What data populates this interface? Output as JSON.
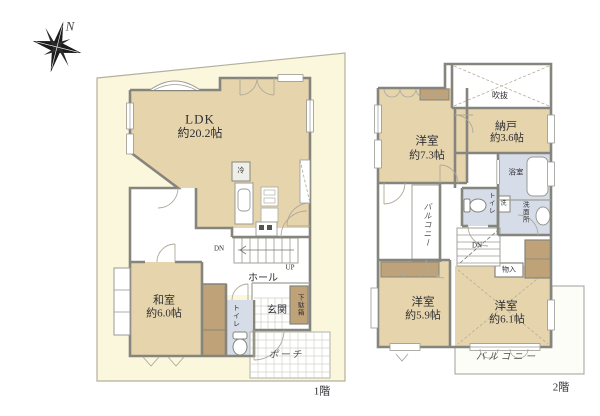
{
  "page": {
    "type": "floor-plan",
    "background": "#ffffff"
  },
  "colors": {
    "room_fill": "#e6d5ac",
    "closet_fill": "#bfa277",
    "wet_area_fill": "#d6dce8",
    "site_fill": "#fbf7dd",
    "wall": "#85857d",
    "text": "#2e2e33"
  },
  "floor1": {
    "floor_label": "1階",
    "compass_n": "N",
    "ldk": {
      "name": "LDK",
      "size": "約20.2帖"
    },
    "washitsu": {
      "name": "和室",
      "size": "約6.0帖"
    },
    "hall": "ホール",
    "genkan": "玄関",
    "porch": "ポーチ",
    "toilet": "トイレ",
    "getabako": "下駄箱",
    "fridge": "冷",
    "stairs": {
      "down": "DN",
      "up": "UP"
    }
  },
  "floor2": {
    "floor_label": "2階",
    "yoshitsu_73": {
      "name": "洋室",
      "size": "約7.3帖"
    },
    "nando": {
      "name": "納戸",
      "size": "約3.6帖"
    },
    "fukinuke": "吹抜",
    "yokushitsu": "浴室",
    "senmenjo": "洗面所",
    "washer": "洗",
    "toilet": "トイレ",
    "balcony_left": "バルコニー",
    "balcony_bottom": "バルコニー",
    "monoire": "物入",
    "stairs": {
      "down": "DN"
    }
  },
  "yoshitsu_59": {
    "name": "洋室",
    "size": "約5.9帖"
  },
  "yoshitsu_61": {
    "name": "洋室",
    "size": "約6.1帖"
  }
}
